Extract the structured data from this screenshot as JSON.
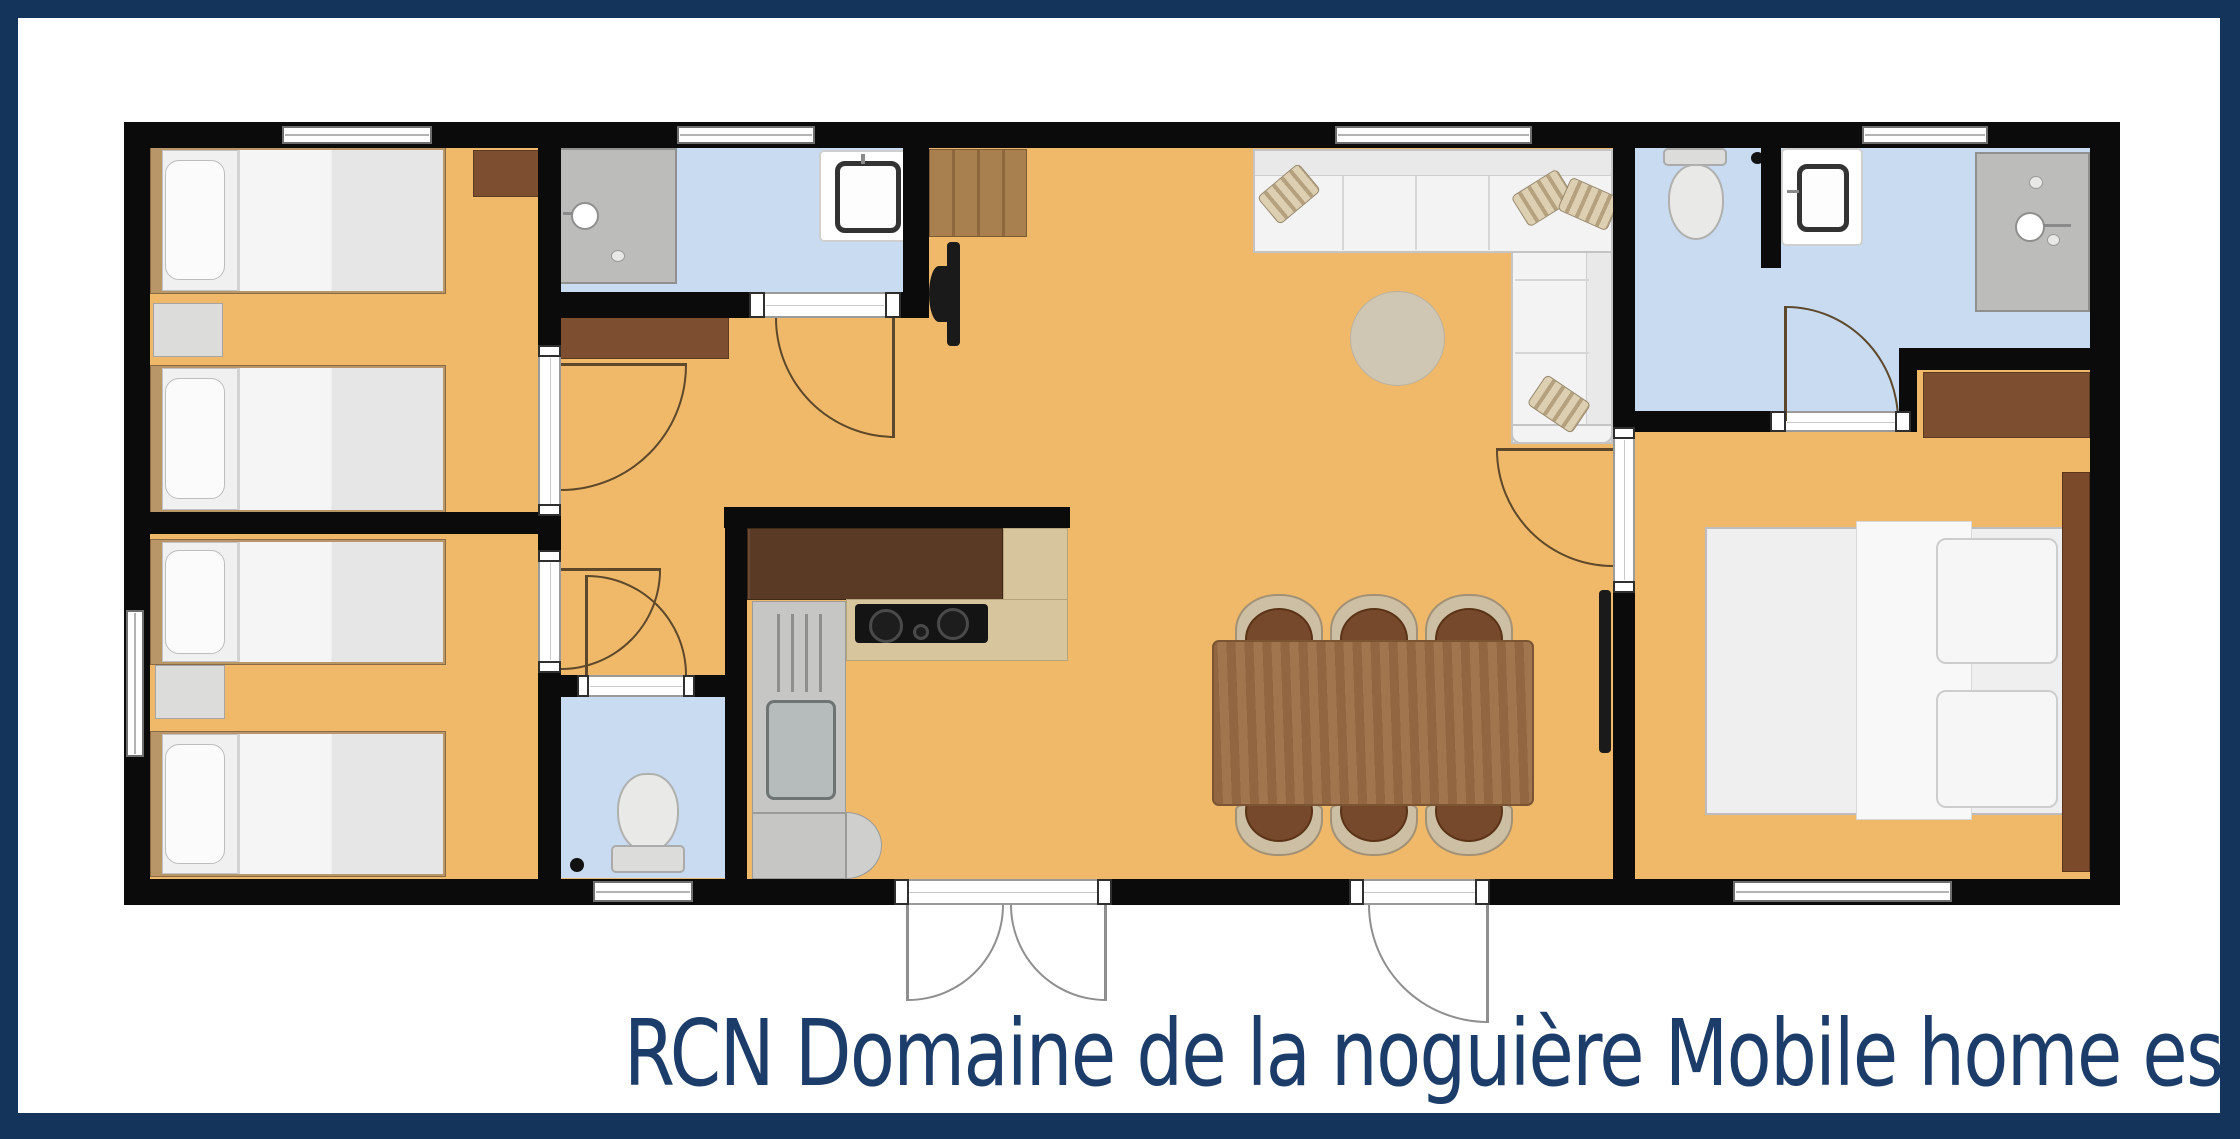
{
  "title": "RCN Domaine de la noguière Mobile home estérel",
  "palette": {
    "navy": "#14345c",
    "floor": "#efb969",
    "wet": "#c9dbf0",
    "wall": "#0b0b0b",
    "titleColor": "#1c3c69"
  },
  "plan": {
    "rooms": [
      {
        "name": "bedroom-twin-front",
        "furniture": [
          "single-bed",
          "single-bed",
          "nightstand",
          "corner-cabinet"
        ]
      },
      {
        "name": "bedroom-twin-back",
        "furniture": [
          "single-bed",
          "single-bed",
          "nightstand"
        ]
      },
      {
        "name": "shower-room",
        "furniture": [
          "shower",
          "washbasin"
        ]
      },
      {
        "name": "wc",
        "furniture": [
          "toilet"
        ]
      },
      {
        "name": "hallway",
        "furniture": [
          "dresser"
        ]
      },
      {
        "name": "kitchen",
        "furniture": [
          "upper-cabinets",
          "countertop",
          "cooktop",
          "sink",
          "corner-unit"
        ]
      },
      {
        "name": "living-dining",
        "furniture": [
          "corner-sofa",
          "round-rug",
          "wardrobe",
          "tv",
          "dining-table",
          "six-chairs",
          "tv"
        ]
      },
      {
        "name": "bathroom",
        "furniture": [
          "toilet",
          "washbasin",
          "shower"
        ]
      },
      {
        "name": "master-bedroom",
        "furniture": [
          "double-bed",
          "dresser",
          "headboard"
        ]
      }
    ],
    "openings": [
      "french-entry-door",
      "terrace-door",
      "6-windows",
      "7-interior-doors"
    ]
  }
}
